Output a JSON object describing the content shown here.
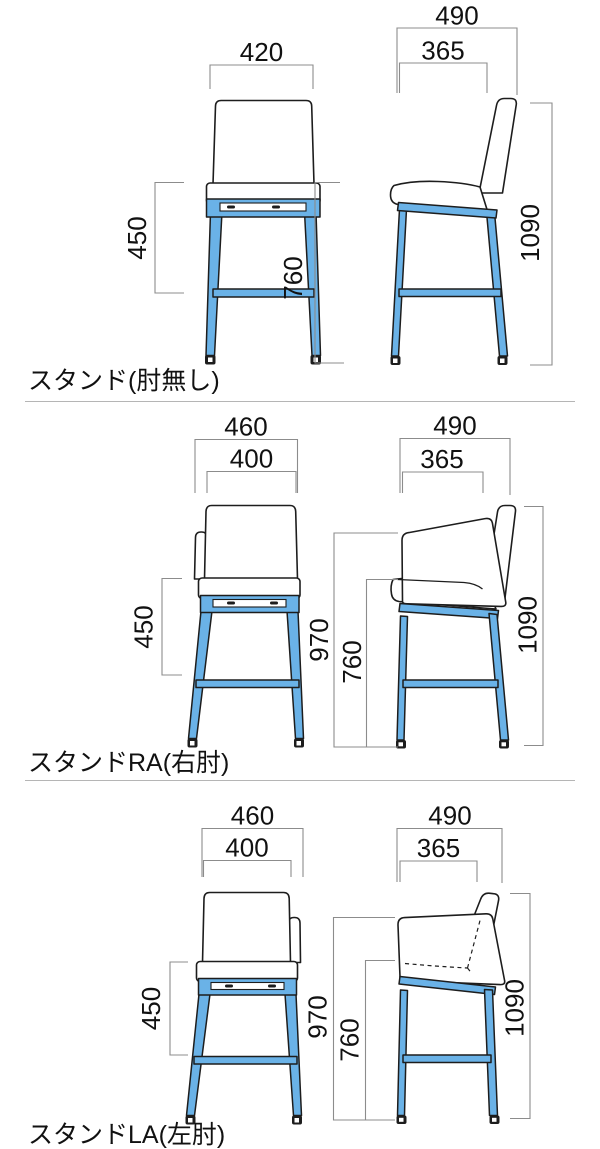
{
  "colors": {
    "frame_blue": "#6ab2e7",
    "outline": "#1d1d1d",
    "dimension_line": "#8c8c8c",
    "text": "#111111",
    "divider": "#b5b5b5",
    "background": "#ffffff"
  },
  "sections": [
    {
      "caption": "スタンド(肘無し)",
      "dims": {
        "front_width": "420",
        "seat_to_footrest": "450",
        "side_depth": "490",
        "seat_depth": "365",
        "seat_height": "760",
        "overall_height": "1090"
      }
    },
    {
      "caption": "スタンドRA(右肘)",
      "dims": {
        "overall_width": "460",
        "seat_width": "400",
        "seat_to_footrest": "450",
        "armrest_height": "970",
        "side_depth": "490",
        "seat_depth": "365",
        "seat_height": "760",
        "overall_height": "1090"
      }
    },
    {
      "caption": "スタンドLA(左肘)",
      "dims": {
        "overall_width": "460",
        "seat_width": "400",
        "seat_to_footrest": "450",
        "armrest_height": "970",
        "side_depth": "490",
        "seat_depth": "365",
        "seat_height": "760",
        "overall_height": "1090"
      }
    }
  ]
}
